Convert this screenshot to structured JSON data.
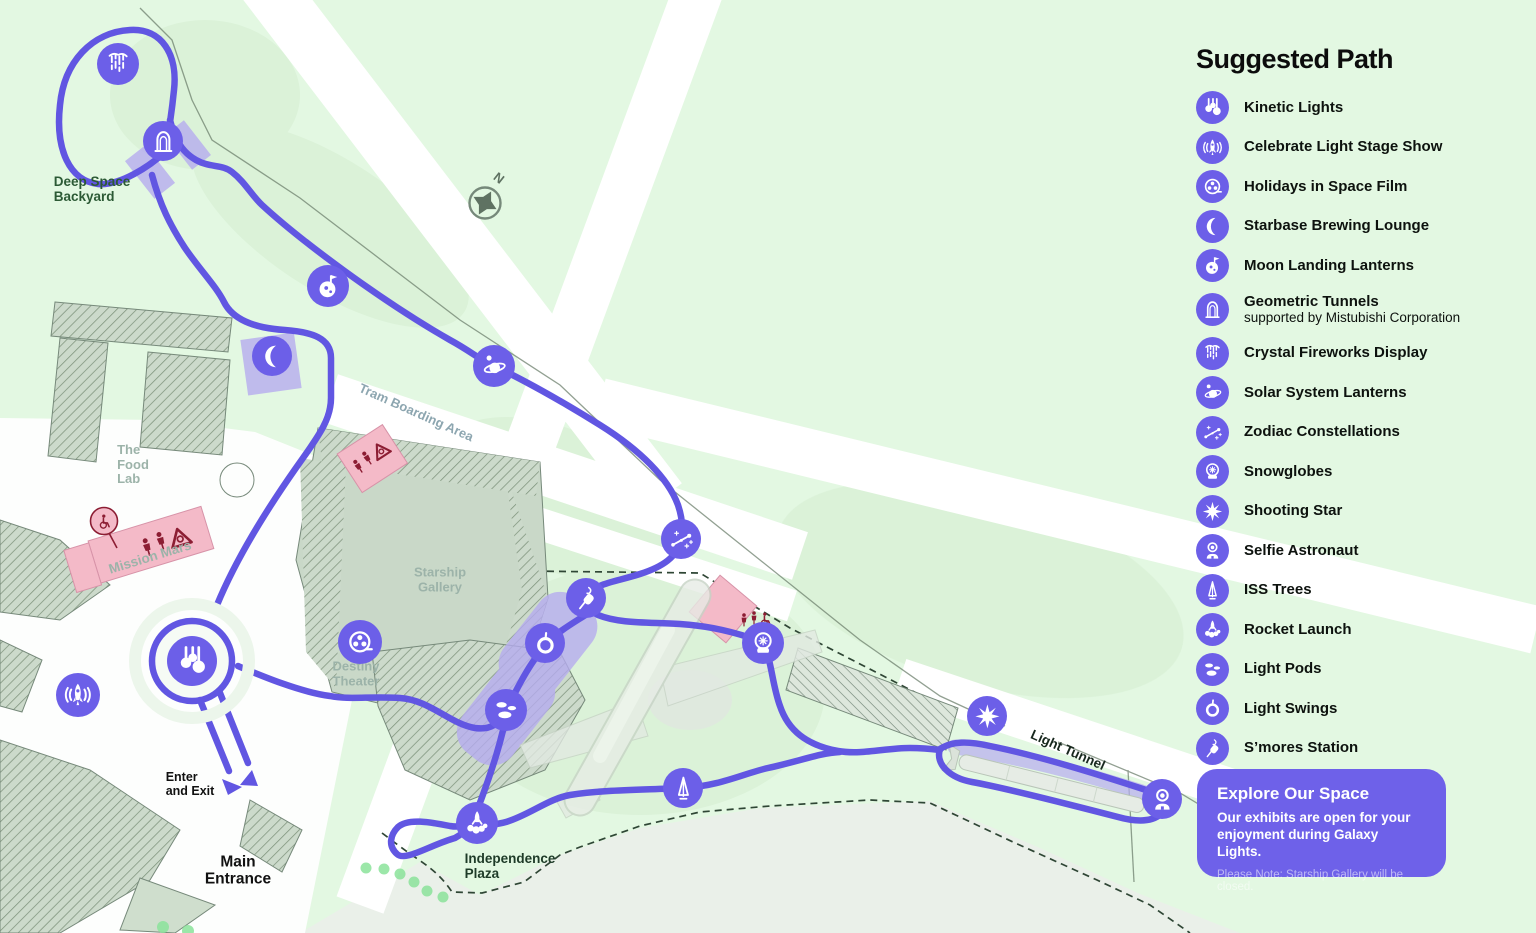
{
  "colors": {
    "background": "#e3f8e2",
    "path_purple": "#6156e2",
    "badge_purple": "#6c5fe8",
    "highlight_purple": "#b6acef",
    "building_sage": "#c9d8c8",
    "pink_amenity": "#f4bac8",
    "amenity_glyph_red": "#8c1d33",
    "dark_green_text": "#2c5a35",
    "gray_green_text": "#9cb3a9"
  },
  "legend": {
    "title": "Suggested Path",
    "items": [
      {
        "icon": "kinetic",
        "label": "Kinetic Lights"
      },
      {
        "icon": "stage",
        "label": "Celebrate Light Stage Show"
      },
      {
        "icon": "film",
        "label": "Holidays in Space Film"
      },
      {
        "icon": "moon",
        "label": "Starbase Brewing Lounge"
      },
      {
        "icon": "moonflag",
        "label": "Moon Landing Lanterns"
      },
      {
        "icon": "tunnel",
        "label": "Geometric Tunnels",
        "sublabel": "supported by Mistubishi Corporation"
      },
      {
        "icon": "fireworks",
        "label": "Crystal Fireworks Display"
      },
      {
        "icon": "saturn",
        "label": "Solar System Lanterns"
      },
      {
        "icon": "zodiac",
        "label": "Zodiac Constellations"
      },
      {
        "icon": "snowglobe",
        "label": "Snowglobes"
      },
      {
        "icon": "star8",
        "label": "Shooting Star"
      },
      {
        "icon": "astronaut",
        "label": "Selfie Astronaut"
      },
      {
        "icon": "isstree",
        "label": "ISS Trees"
      },
      {
        "icon": "rocketlaunch",
        "label": "Rocket Launch"
      },
      {
        "icon": "pods",
        "label": "Light Pods"
      },
      {
        "icon": "swing",
        "label": "Light Swings"
      },
      {
        "icon": "smores",
        "label": "S’mores Station"
      }
    ]
  },
  "notice": {
    "title": "Explore Our Space",
    "body": "Our exhibits are open for your enjoyment during Galaxy Lights.",
    "note": "Please Note: Starship Gallery will be closed."
  },
  "compass": {
    "label": "N"
  },
  "map": {
    "labels": [
      {
        "id": "deep-space-backyard",
        "text": "Deep Space\nBackyard",
        "x": 92,
        "y": 189,
        "size": 13.5,
        "color": "#2c5a35",
        "rotate": 0,
        "align": "left"
      },
      {
        "id": "the-food-lab",
        "text": "The\nFood\nLab",
        "x": 133,
        "y": 465,
        "size": 13,
        "color": "#9cb3a9",
        "rotate": 0,
        "align": "left"
      },
      {
        "id": "mission-mars",
        "text": "Mission Mars",
        "x": 150,
        "y": 557,
        "size": 13.5,
        "color": "#9cb3a9",
        "rotate": -17,
        "align": "center"
      },
      {
        "id": "tram-boarding-area",
        "text": "Tram Boarding Area",
        "x": 416,
        "y": 413,
        "size": 13,
        "color": "#8da6b0",
        "rotate": 24,
        "align": "center"
      },
      {
        "id": "starship-gallery",
        "text": "Starship\nGallery",
        "x": 440,
        "y": 580,
        "size": 13,
        "color": "#9cb3a9",
        "rotate": 0,
        "align": "center"
      },
      {
        "id": "destiny-theater",
        "text": "Destiny\nTheater",
        "x": 356,
        "y": 674,
        "size": 13,
        "color": "#9cb3a9",
        "rotate": 0,
        "align": "center"
      },
      {
        "id": "independence-plaza",
        "text": "Independence\nPlaza",
        "x": 510,
        "y": 866,
        "size": 13.5,
        "color": "#1e3b28",
        "rotate": 0,
        "align": "left"
      },
      {
        "id": "enter-and-exit",
        "text": "Enter\nand Exit",
        "x": 190,
        "y": 784,
        "size": 12.5,
        "color": "#111111",
        "rotate": 0,
        "align": "left"
      },
      {
        "id": "main-entrance",
        "text": "Main\nEntrance",
        "x": 238,
        "y": 871,
        "size": 15.5,
        "color": "#111111",
        "rotate": 0,
        "align": "center"
      },
      {
        "id": "light-tunnel",
        "text": "Light Tunnel",
        "x": 1068,
        "y": 750,
        "size": 13.5,
        "color": "#18281e",
        "rotate": 24,
        "align": "center"
      }
    ],
    "pois": [
      {
        "id": "crystal-fireworks-display",
        "icon": "fireworks",
        "x": 118,
        "y": 64,
        "size": 42
      },
      {
        "id": "geometric-tunnels",
        "icon": "tunnel",
        "x": 163,
        "y": 141,
        "size": 40
      },
      {
        "id": "moon-landing-lanterns",
        "icon": "moonflag",
        "x": 328,
        "y": 286,
        "size": 42
      },
      {
        "id": "starbase-brewing-lounge",
        "icon": "moon",
        "x": 272,
        "y": 356,
        "size": 40
      },
      {
        "id": "solar-system-lanterns",
        "icon": "saturn",
        "x": 494,
        "y": 366,
        "size": 42
      },
      {
        "id": "zodiac-constellations",
        "icon": "zodiac",
        "x": 681,
        "y": 539,
        "size": 40
      },
      {
        "id": "snowglobes",
        "icon": "snowglobe",
        "x": 763,
        "y": 643,
        "size": 42
      },
      {
        "id": "smores-station",
        "icon": "smores",
        "x": 586,
        "y": 598,
        "size": 40
      },
      {
        "id": "light-swings",
        "icon": "swing",
        "x": 545,
        "y": 643,
        "size": 40
      },
      {
        "id": "light-pods",
        "icon": "pods",
        "x": 506,
        "y": 710,
        "size": 42
      },
      {
        "id": "rocket-launch",
        "icon": "rocketlaunch",
        "x": 477,
        "y": 823,
        "size": 42
      },
      {
        "id": "iss-trees",
        "icon": "isstree",
        "x": 683,
        "y": 788,
        "size": 40
      },
      {
        "id": "kinetic-lights",
        "icon": "kinetic",
        "x": 192,
        "y": 661,
        "size": 50
      },
      {
        "id": "celebrate-light-stage-show",
        "icon": "stage",
        "x": 78,
        "y": 695,
        "size": 44
      },
      {
        "id": "holidays-in-space-film",
        "icon": "film",
        "x": 360,
        "y": 642,
        "size": 44
      },
      {
        "id": "shooting-star",
        "icon": "star8",
        "x": 987,
        "y": 716,
        "size": 40
      },
      {
        "id": "selfie-astronaut",
        "icon": "astronaut",
        "x": 1162,
        "y": 799,
        "size": 40
      }
    ]
  }
}
